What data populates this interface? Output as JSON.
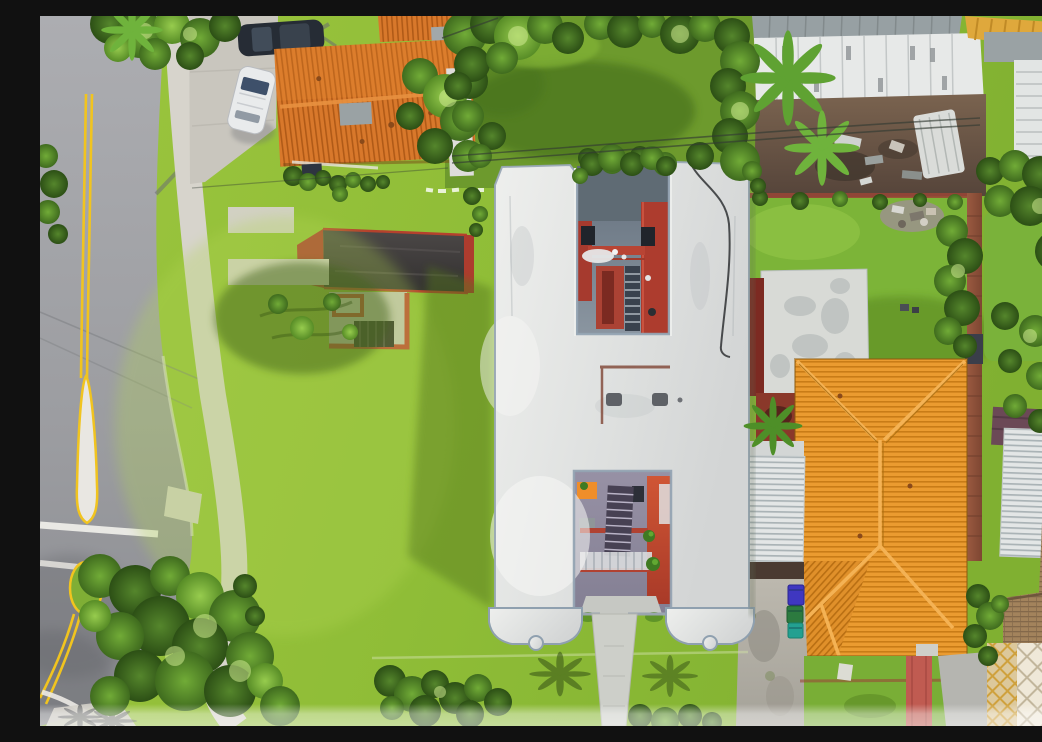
{
  "image": {
    "type": "aerial-drone-photograph",
    "description": "Top-down aerial photo of an H-shaped white flat-roof apartment building on a large lime-green lawn, flanked by orange clay-tile roof houses, a gray street with double yellow lines and a painted median island on the left, gardens, palm trees, a white corrugated carport with trash bins, and a decorative paver patio at lower right.",
    "width": 1042,
    "height": 710
  },
  "palette": {
    "asphalt": "#a3a4a8",
    "asphalt_dark": "#8e8f94",
    "yellow_line": "#f1c41f",
    "island_white": "#e9e7e2",
    "sidewalk": "#d7d4cc",
    "concrete": "#c9c6be",
    "lawn_bright": "#a0c840",
    "lawn": "#8fbd37",
    "lawn_dark": "#5d7f1f",
    "tree_dark": "#2c4f15",
    "tree_mid": "#3f6b1e",
    "tree_light": "#578c26",
    "roof_white": "#e2e3e1",
    "parapet_shadow": "#8fa0af",
    "court_floor": "#707c86",
    "red_wall": "#ad3c2e",
    "red_bright": "#c94f35",
    "orange_awning": "#ef8e2a",
    "tile_orange": "#ea9b30",
    "tile_stripe": "#c87c17",
    "tile_ridge": "#f4b254",
    "tile_topleft": "#d8782b",
    "metal_gray": "#97a0a3",
    "panel_white": "#e7e9e8",
    "dirt": "#6f594a",
    "fence_red": "#9a4537",
    "shed_white": "#d8dad6",
    "deck_red": "#7c2a22",
    "corrugated": "#e3e6e6",
    "driveway": "#b6b2a9",
    "bin_blue": "#3f37c0",
    "bin_green": "#2c7a3f",
    "bin_teal": "#23a091",
    "red_path": "#c05b51",
    "paver_gold": "#cfa13d",
    "shingle": "#a3835c",
    "car_dark": "#262c35",
    "car_white": "#e9ebec",
    "fade_band": "#ffffff"
  },
  "scene": {
    "regions": [
      {
        "name": "street",
        "description": "gray asphalt road, double yellow center line, white painted median island with yellow border, crosswalk bar, grass median island with trees"
      },
      {
        "name": "sidewalk",
        "description": "light concrete sidewalk curving along the street"
      },
      {
        "name": "front-lawn",
        "description": "large bright lime lawn with tree shadows"
      },
      {
        "name": "h-building",
        "description": "white flat-roof H-shaped building with two inner courtyards showing red walls and staircases, scalloped parapets at the south legs, entry walkway"
      },
      {
        "name": "top-left-house",
        "description": "orange clay tile gable roof, concrete driveway, white SUV, dark parked car"
      },
      {
        "name": "accessory-building",
        "description": "dark gray roof with red trim, concrete patio with red border and dark pergola"
      },
      {
        "name": "top-right-property",
        "description": "white industrial panel roof with gray metal edge, brown dirt yard with debris and white trailer, yellow awning corner"
      },
      {
        "name": "right-house",
        "description": "large orange clay tile hip roof, white corrugated carport, concrete driveway with blue, green and teal trash bins, red walkway"
      },
      {
        "name": "bottom-right",
        "description": "decorative diamond paver patio and tan shingle roofs"
      },
      {
        "name": "vegetation",
        "description": "palms, tree canopies along street, gardens and right fence line"
      },
      {
        "name": "bottom-fade",
        "description": "translucent white band across the bottom edge of the photo"
      }
    ],
    "trash_bin_colors": [
      "blue",
      "green",
      "teal"
    ]
  }
}
